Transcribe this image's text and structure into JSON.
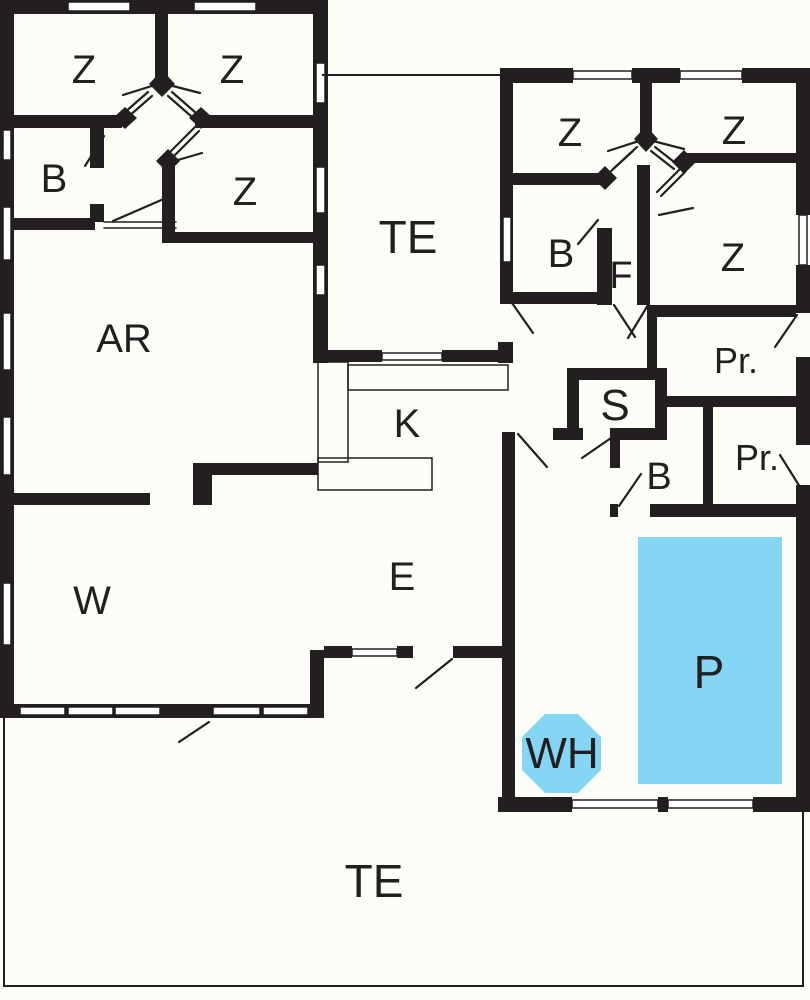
{
  "plan_title": "house floor plan",
  "colors": {
    "wall": "#231f20",
    "pool": "#85d6f4",
    "background": "#fdfdf8",
    "window_fill": "#ffffff"
  },
  "rooms": {
    "z1": "Z",
    "z2": "Z",
    "b1": "B",
    "z3": "Z",
    "ar": "AR",
    "te1": "TE",
    "k": "K",
    "w": "W",
    "e": "E",
    "te2": "TE",
    "z4": "Z",
    "z5": "Z",
    "b2": "B",
    "f": "F",
    "z6": "Z",
    "pr1": "Pr.",
    "s": "S",
    "b3": "B",
    "pr2": "Pr.",
    "p": "P",
    "wh": "WH"
  }
}
